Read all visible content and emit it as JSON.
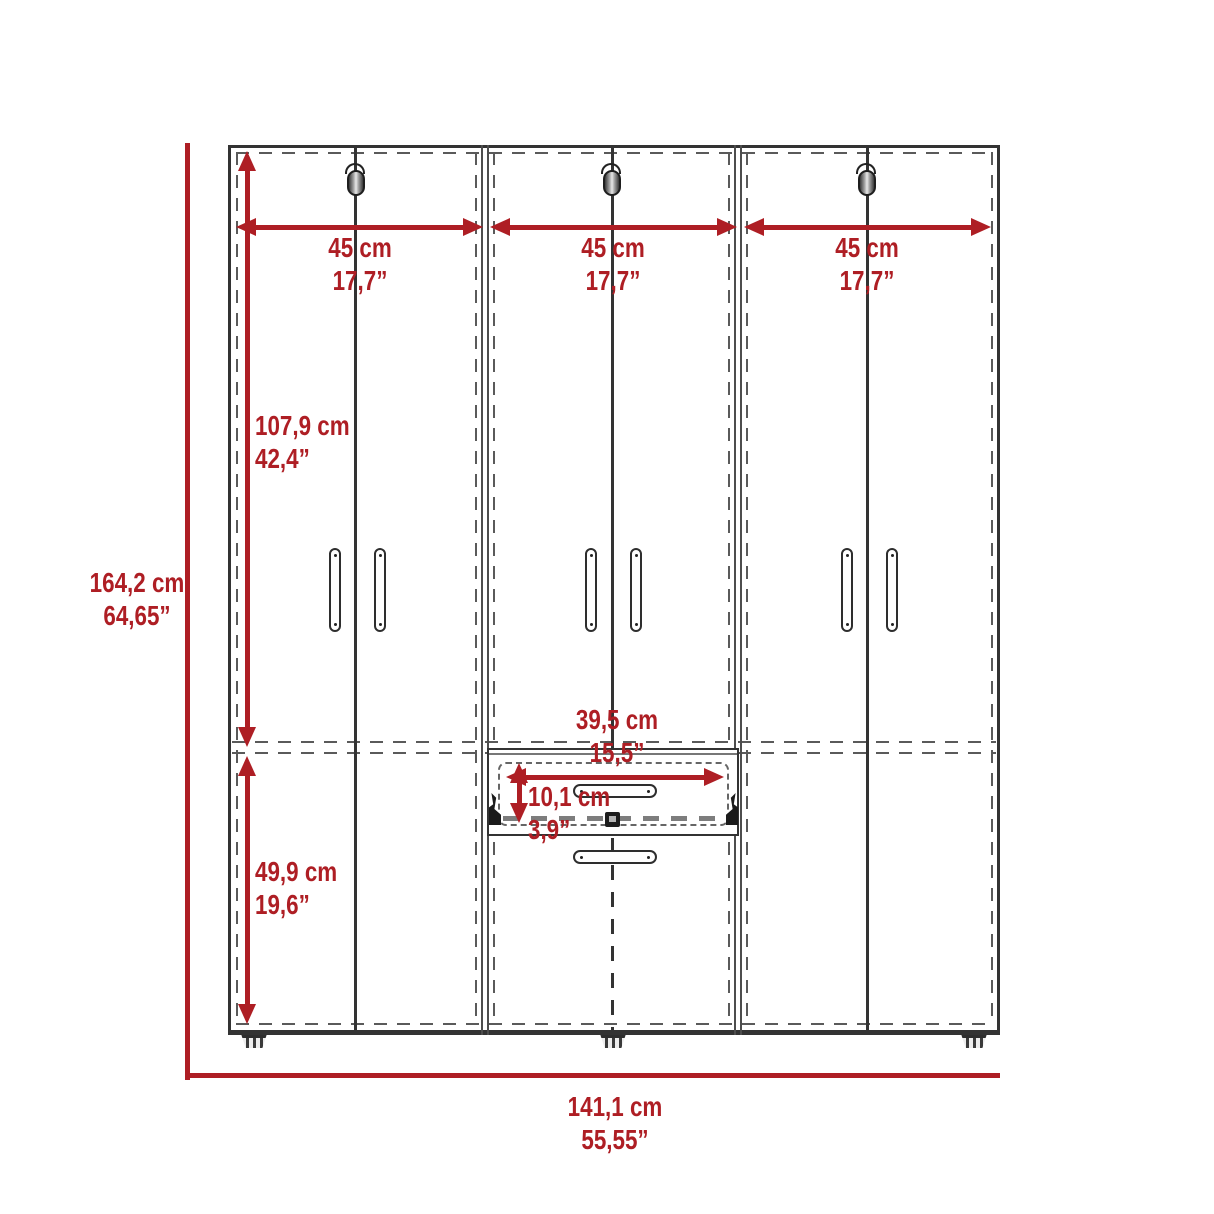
{
  "diagram": {
    "kind": "furniture dimension drawing",
    "figure": "three-door wardrobe with center drawers, front elevation",
    "units_shown": [
      "cm",
      "inches"
    ]
  },
  "dims": {
    "overall_height": {
      "cm": "164,2 cm",
      "inch": "64,65”"
    },
    "overall_width": {
      "cm": "141,1 cm",
      "inch": "55,55”"
    },
    "door_left": {
      "cm": "45 cm",
      "inch": "17,7”"
    },
    "door_center": {
      "cm": "45 cm",
      "inch": "17,7”"
    },
    "door_right": {
      "cm": "45 cm",
      "inch": "17,7”"
    },
    "upper_section_height": {
      "cm": "107,9 cm",
      "inch": "42,4”"
    },
    "lower_section_height": {
      "cm": "49,9 cm",
      "inch": "19,6”"
    },
    "drawer_width": {
      "cm": "39,5 cm",
      "inch": "15,5”"
    },
    "drawer_height": {
      "cm": "10,1 cm",
      "inch": "3,9”"
    }
  },
  "icons": {
    "hinge": "capsule with hook",
    "door_handle": "vertical pill",
    "drawer_handle": "horizontal pill",
    "foot": "striped trapezoid",
    "drawer_slide": "bracket hardware"
  },
  "colors": {
    "dimension_red": "#AE1E24",
    "outline_dark": "#333333",
    "dash_gray": "#5a5a5a",
    "divider_gray": "#4d4d4d",
    "background": "#ffffff"
  }
}
